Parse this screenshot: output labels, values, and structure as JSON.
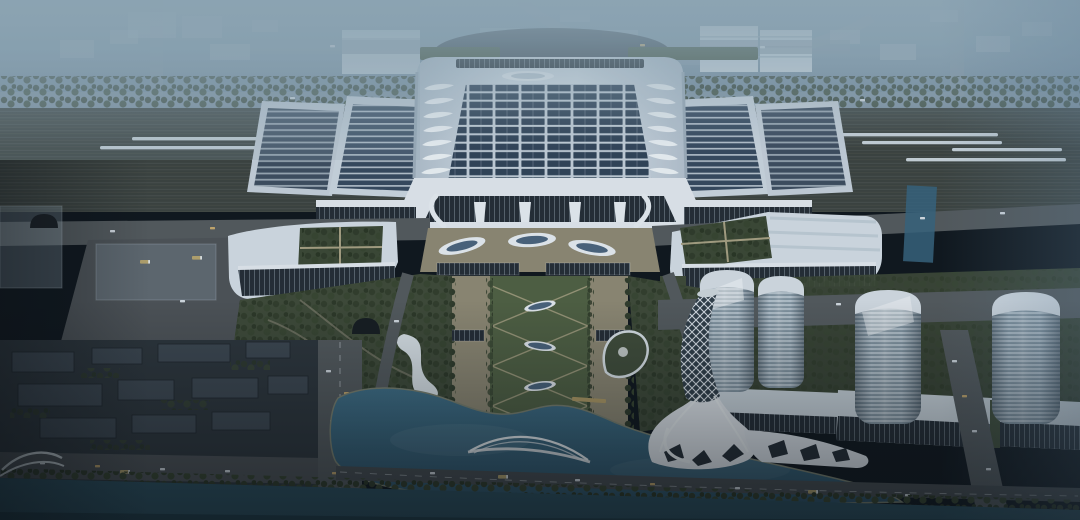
{
  "scene": {
    "description": "Aerial dusk architectural rendering of a large high-speed railway station: a white hall roof covered with a grid of dark solar panels and teardrop skylights, flanked by angled solar platform canopies over railway tracks with white trains; two annex buildings with green roof courtyards; a formal landscaped axis with oval skylights leading to a lake crossed by an arch bridge; a twisted white lattice landmark tower on the lakeshore; four cylindrical striped office towers with podium halls on the right; dark low-rise city blocks and wide roads on the lower left; a tree-lined canal across the foreground; hazy blue city in the distance",
    "time_of_day": "dusk",
    "landmarks": [
      "railway-station-hall",
      "solar-roof-array",
      "teardrop-skylights",
      "platform-canopies",
      "left-annex-green-courtyard",
      "right-annex-green-courtyard",
      "central-plaza-axis",
      "formal-garden",
      "oval-skylights",
      "lake",
      "arch-bridge",
      "twisted-lattice-tower",
      "cylindrical-towers",
      "podium-halls",
      "high-speed-trains",
      "railway-tracks",
      "city-blocks",
      "canal",
      "distant-city-haze"
    ]
  },
  "palette": {
    "sky_top": "#8FA6B4",
    "sky_low": "#768C9C",
    "haze": "#93AAB8",
    "city_far": "#AFBCC6",
    "city_white": "#D2DCE2",
    "tracks": "#3A3F3B",
    "train": "#CBD4DA",
    "roof": "#CDD6DF",
    "roof_edge": "#9FADBA",
    "facade_glass": "#222930",
    "solar": "#2F4054",
    "solar_gap": "#C6D0D9",
    "canopy": "#E4E9EE",
    "strip_dark": "#35465B",
    "green": "#3D4733",
    "green_tree": "#2E3825",
    "lawn": "#4F5E3E",
    "plaza": "#8F8770",
    "plaza_light": "#A89F7F",
    "road": "#53575A",
    "road_dark": "#45494C",
    "lane": "#C9CED2",
    "lake": "#36627B",
    "lake_deep": "#294C60",
    "canal": "#2A4E5D",
    "block": "#2B3137",
    "block_top": "#3B444D",
    "tower_light": "#B7C3CC",
    "tower_dark": "#8495A1",
    "tower_cap": "#D6DDE3",
    "glass_blue": "#49617A",
    "white": "#E9EDF1",
    "tint": "#3C6384",
    "vignette": "#0A0F14"
  }
}
